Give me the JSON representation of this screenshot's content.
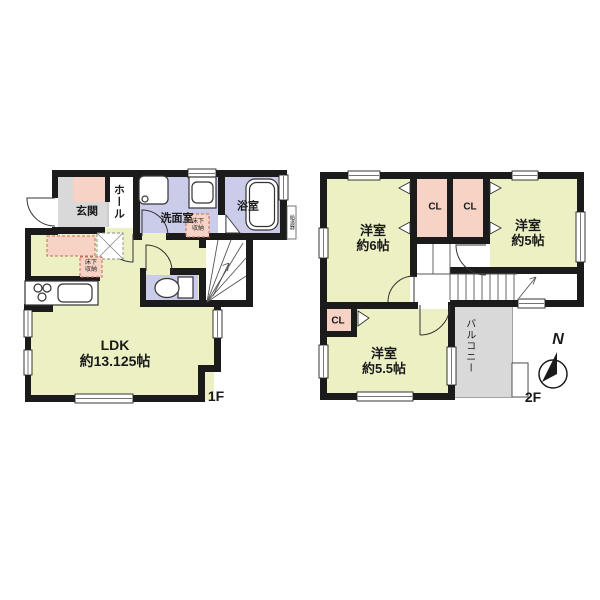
{
  "floor1": {
    "floor_label": "1F",
    "entrance_label": "玄関",
    "hall_label": "ホール",
    "washroom_label": "洗面室",
    "bath_label": "浴室",
    "ldk_label_line1": "LDK",
    "ldk_label_line2": "約13.125帖",
    "underfloor_storage_line1": "床下",
    "underfloor_storage_line2": "収納",
    "water_heater_label": "給湯器"
  },
  "floor2": {
    "floor_label": "2F",
    "bedroom1_line1": "洋室",
    "bedroom1_line2": "約6帖",
    "bedroom2_line1": "洋室",
    "bedroom2_line2": "約5帖",
    "bedroom3_line1": "洋室",
    "bedroom3_line2": "約5.5帖",
    "closet_label": "CL",
    "balcony_label": "バルコニー",
    "compass_north_label": "N"
  },
  "colors": {
    "room_yellow": "#edf0c3",
    "wet_purple": "#cbcce9",
    "accent_pink": "#f7d3c6",
    "floor_gray": "#d9d9d9",
    "wall_black": "#1b1b1b"
  }
}
